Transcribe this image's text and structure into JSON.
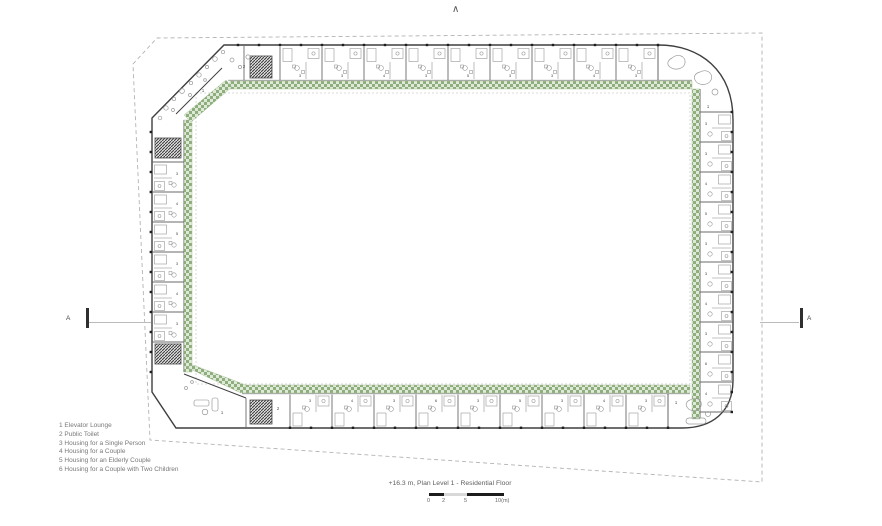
{
  "plan": {
    "north_arrow_glyph": "∧",
    "section_marker_left": "A",
    "section_marker_right": "A",
    "room_labels": {
      "elevator_lounge": "1",
      "public_toilet": "2"
    },
    "unit_numbers": {
      "top": [
        "3",
        "3",
        "4",
        "3",
        "5",
        "3",
        "3",
        "4",
        "3"
      ],
      "bottom": [
        "3",
        "4",
        "3",
        "6",
        "3",
        "5",
        "3",
        "4",
        "3"
      ],
      "left": [
        "3",
        "4",
        "5",
        "3",
        "4",
        "3"
      ],
      "right": [
        "3",
        "3",
        "4",
        "5",
        "3",
        "3",
        "4",
        "3",
        "6",
        "4"
      ]
    },
    "colors": {
      "wall": "#3f3f3f",
      "divider": "#6a6a6a",
      "furniture": "#8f8f8f",
      "boundary_dash": "#b3b3b3",
      "corridor_green_light": "#dfe9d8",
      "corridor_green_dark": "#8fae7e",
      "corridor_green_edge": "#9dba8d",
      "courtyard_line": "#d0d0d0",
      "column": "#1f1f1f",
      "core_hatch": "#3a3a3a",
      "plant": "#9a9a9a",
      "label": "#4a4a4a"
    }
  },
  "legend": {
    "items": [
      "1 Elevator Lounge",
      "2 Public Toilet",
      "3 Housing for a Single Person",
      "4 Housing for a Couple",
      "5 Housing for an Elderly Couple",
      "6 Housing for a Couple with Two Children"
    ]
  },
  "caption": "+16.3 m, Plan Level 1 - Residential Floor",
  "scale_bar": {
    "ticks": [
      "0",
      "2",
      "5",
      "10(m)"
    ]
  }
}
